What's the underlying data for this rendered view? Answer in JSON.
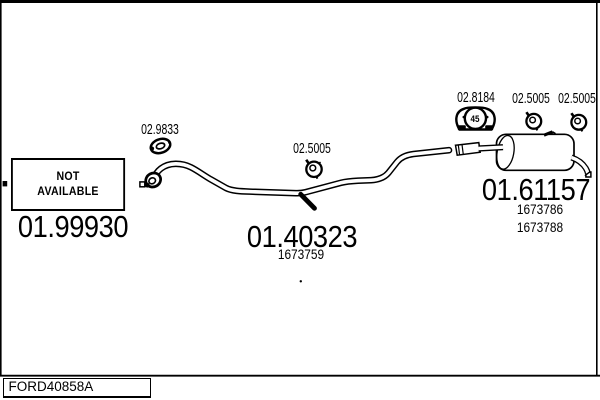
{
  "page": {
    "background": "#ffffff",
    "ink": "#000000"
  },
  "footer": {
    "code": "FORD40858A"
  },
  "not_available_box": {
    "line1": "NOT",
    "line2": "AVAILABLE"
  },
  "parts": {
    "front_section": {
      "code": "01.99930"
    },
    "front_gasket": {
      "code": "02.9833"
    },
    "centre_clamp": {
      "code": "02.5005"
    },
    "centre_pipe": {
      "code": "01.40323",
      "ref": "1673759"
    },
    "rear_hanger": {
      "code": "02.8184",
      "label": "45"
    },
    "rear_clamp_left": {
      "code": "02.5005"
    },
    "rear_clamp_right": {
      "code": "02.5005"
    },
    "rear_silencer": {
      "code": "01.61157",
      "ref1": "1673786",
      "ref2": "1673788"
    }
  }
}
